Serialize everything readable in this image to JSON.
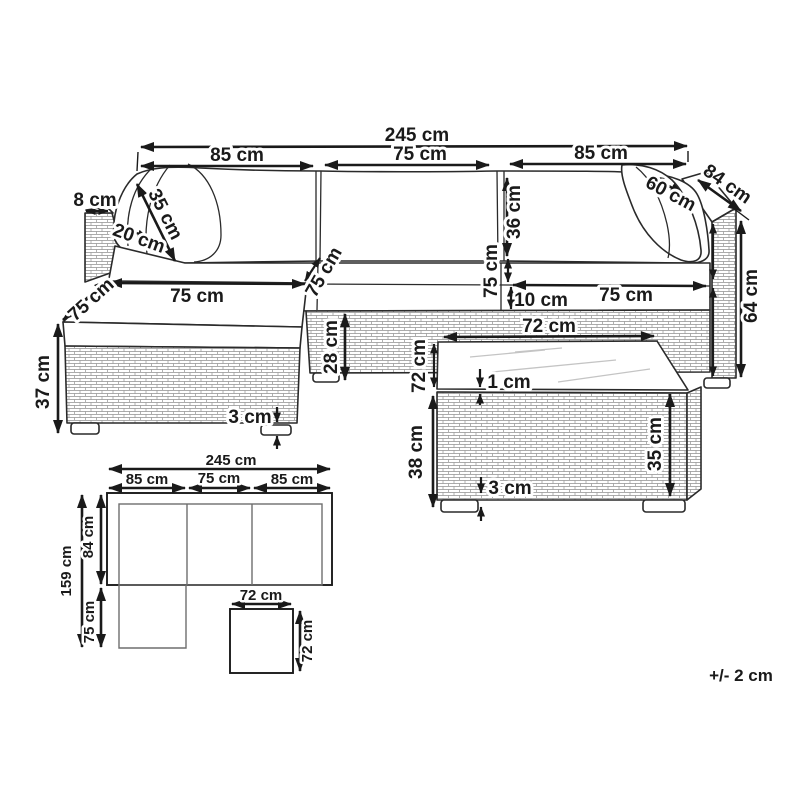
{
  "tolerance_note": "+/- 2 cm",
  "colors": {
    "ink": "#1a1a1a",
    "brick_line": "#909090",
    "glass_line": "#c4c4c4",
    "background": "#ffffff"
  },
  "perspective": {
    "overall_width": "245 cm",
    "left_width": "85 cm",
    "middle_width": "75 cm",
    "right_width": "85 cm",
    "arm_top_width": "8 cm",
    "back_cushion_diag": "35 cm",
    "arm_cushion_depth": "20 cm",
    "chaise_width": "75 cm",
    "chaise_side_depth": "75 cm",
    "left_seat_depth": "75 cm",
    "backrest_height": "36 cm",
    "right_seat_depth": "75 cm",
    "seat_cushion_thickness": "10 cm",
    "right_seat_width": "75 cm",
    "corner_cushion_width": "60 cm",
    "unit_depth": "84 cm",
    "arm_height": "64 cm",
    "chaise_height": "37 cm",
    "base_height": "28 cm",
    "foot_height": "3 cm"
  },
  "table": {
    "top_width": "72 cm",
    "top_side_depth": "72 cm",
    "glass_thickness": "1 cm",
    "total_height": "38 cm",
    "body_height": "35 cm",
    "foot_height": "3 cm"
  },
  "plan": {
    "overall_width": "245 cm",
    "left_width": "85 cm",
    "middle_width": "75 cm",
    "right_width": "85 cm",
    "overall_depth": "159 cm",
    "sofa_depth": "84 cm",
    "chaise_extension": "75 cm",
    "table_width": "72 cm",
    "table_depth": "72 cm"
  }
}
